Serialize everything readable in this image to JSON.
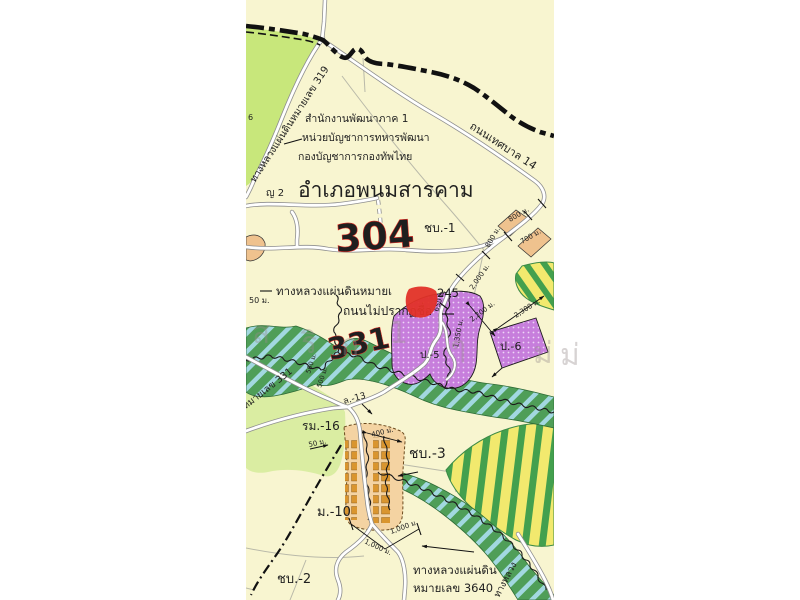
{
  "map": {
    "title": "อำเภอพนมสารคาม",
    "agency_lines": [
      "สำนักงานพัฒนาภาค 1",
      "หน่วยบัญชาการทหารพัฒนา",
      "กองบัญชาการกองทัพไทย"
    ],
    "roads": {
      "hwy319": "ทางหลวงแผ่นดินหมายเลข 319",
      "thetsaban14": "ถนนเทศบาล 14",
      "hwy3245_part1": "ทางหลวงแผ่นดินหมายเ",
      "hwy3245_part2": "245",
      "unnamed_road": "ถนนไม่ปรากฏชื่อ",
      "hwy331": "ทางหลวงแผ่นดินหมายเลข 331",
      "hwy3640_line1": "ทางหลวงแผ่นดิน",
      "hwy3640_line2": "หมายเลข 3640",
      "hwy_diag_fragment": "ทางหลวง"
    },
    "annotations_red": {
      "num304": "304",
      "num331": "331"
    },
    "zones": {
      "chb1": "ชบ.-1",
      "chb2": "ชบ.-2",
      "chb3": "ชบ.-3",
      "m10": "ม.-10",
      "rm16": "รม.-16",
      "p5": "ป.-5",
      "p6": "ป.-6",
      "yo2": "ญ 2",
      "l13": "ล.-13",
      "six": "6"
    },
    "measurements": {
      "m800a": "800 ม.",
      "m800b": "800 ม.",
      "m700": "700 ม.",
      "m2000": "2,000 ม.",
      "m650": "650 ม.",
      "m2200": "2,200 ม.",
      "m2300": "2,300 ม.",
      "m1350": "1,350 ม.",
      "m50a": "50 ม.",
      "m50b": "50 ม.",
      "m400": "400 ม.",
      "m1000a": "1,000 ม.",
      "m1000b": "1,000 ม.",
      "m500a": "500 ม.",
      "m500b": "500 ม."
    },
    "watermark_glyphs": [
      "ส",
      "ริ",
      "ก",
      "1",
      "ๆ",
      "ม่",
      "ม่"
    ],
    "colors": {
      "map_background": "#F8F5D0",
      "highway_green": "#C8E77B",
      "pale_green": "#DAEDA2",
      "stream_corridor_green": "#4F9E58",
      "stream_hatch_blue": "#A6DBE8",
      "parcel_purple": "#C77EDC",
      "parcel_orange": "#EFC28E",
      "village_orange": "#F4D3A2",
      "building_orange": "#D9952F",
      "parcel_yellow": "#F2E96E",
      "stripe_green": "#43A04E",
      "red_annotation": "#E23128",
      "teal_label": "#177D6E",
      "boundary_black": "#111111",
      "road_white": "#FFFFFF",
      "road_casing": "#8F8F8F"
    }
  }
}
